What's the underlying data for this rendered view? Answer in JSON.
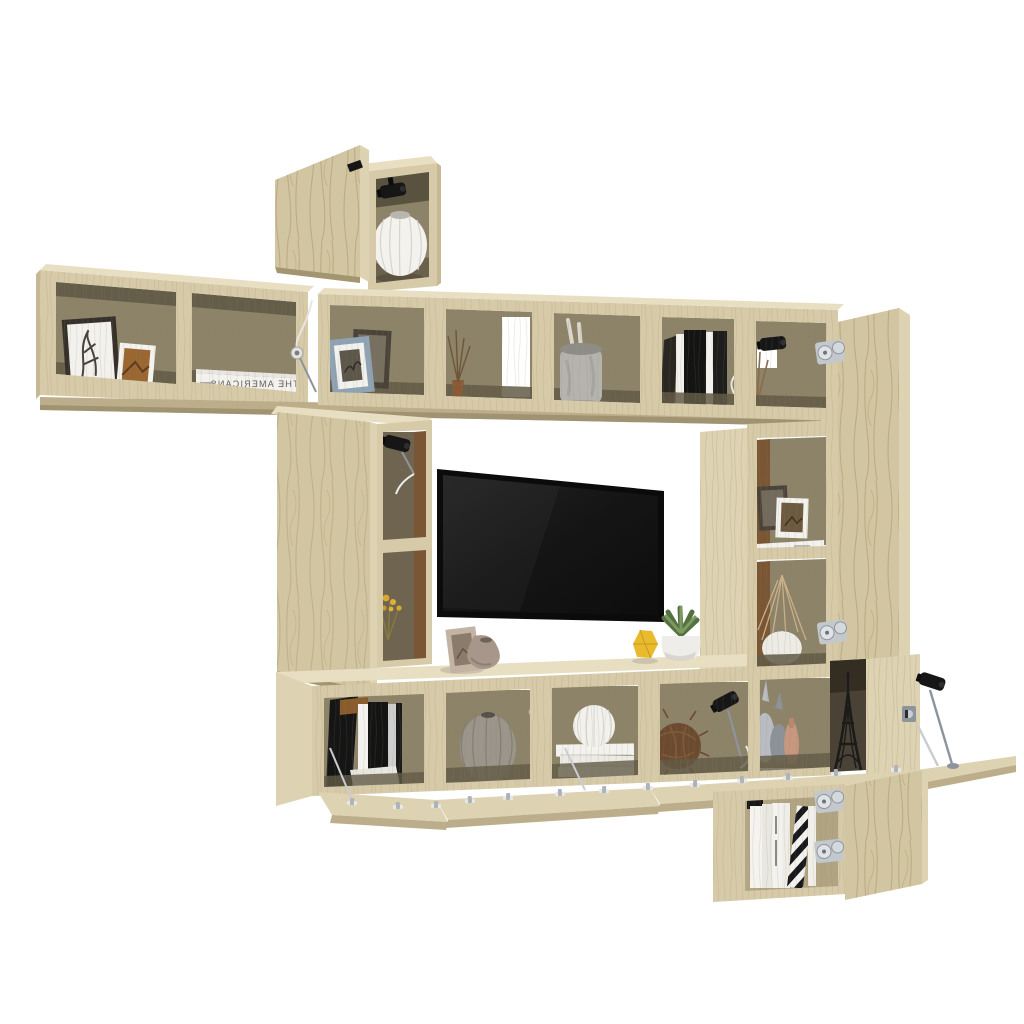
{
  "meta": {
    "type": "product-photo",
    "subject": "9-piece modular TV wall-unit set in Sonoma oak: open wall cubes, swing and fold-down doors, wall-mounted flat-screen TV and styling decor on a white background"
  },
  "palette": {
    "background": "#ffffff",
    "wood_front": "#d6caa8",
    "wood_top": "#e8dfc3",
    "wood_side_light": "#ddd2b1",
    "wood_side_dark": "#c6b894",
    "wood_door": "#d2c5a1",
    "board_front": "#bcae8a",
    "interior_back": "#8d8369",
    "interior_warm": "#7a5634",
    "interior_side": "#b3a785",
    "interior_floor": "#625a46",
    "deep_shadow": "#3c372a",
    "tv_bezel": "#0b0b0b",
    "tv_screen": "#181818",
    "metal": "#c9cdd2",
    "metal_dark": "#8e949b",
    "hardware_black": "#161616",
    "white_decor": "#f3f2ee",
    "gray_vase": "#9b958b",
    "jar_gray": "#b5b3ae",
    "frame_blue": "#8fa3b5",
    "frame_dark": "#49433a",
    "frame_beige": "#c2b3a2",
    "taupe_vase": "#a6978a",
    "yellow_decor": "#eaba2e",
    "plant_green": "#7d9a63",
    "plant_dark": "#55713f",
    "twig_brown": "#6b4a30",
    "peach_vase": "#c8977f",
    "bird_gray": "#b9bdc3",
    "flower_yellow": "#d9a92c",
    "book_black": "#141414",
    "text_gray": "#5f5f5f"
  },
  "decor": {
    "book_spine_text": "THE AMERICANS",
    "book_spine_mirrored": true,
    "items": [
      "top wall cube with open door and ribbed white vase",
      "clip-on black spotlights",
      "framed botanical prints",
      "white coffee-table book",
      "small chrome cable lamps",
      "ceramic jar with utensils",
      "row of standing books",
      "dried twigs in bud vase",
      "wall-mounted flat-screen TV",
      "leaning beige photo frame",
      "taupe sculptural vase",
      "yellow faceted ornament",
      "succulent in white pot",
      "dried yellow flowers",
      "black storage boxes with white magazine file",
      "gray ribbed vase",
      "white ribbed sphere on stacked books",
      "rattan twig sphere",
      "sculptural gray bud vases",
      "peach bud vase",
      "Eiffel Tower figurine",
      "white and black-striped books",
      "chrome concealed hinges and fold-down door stays"
    ]
  }
}
